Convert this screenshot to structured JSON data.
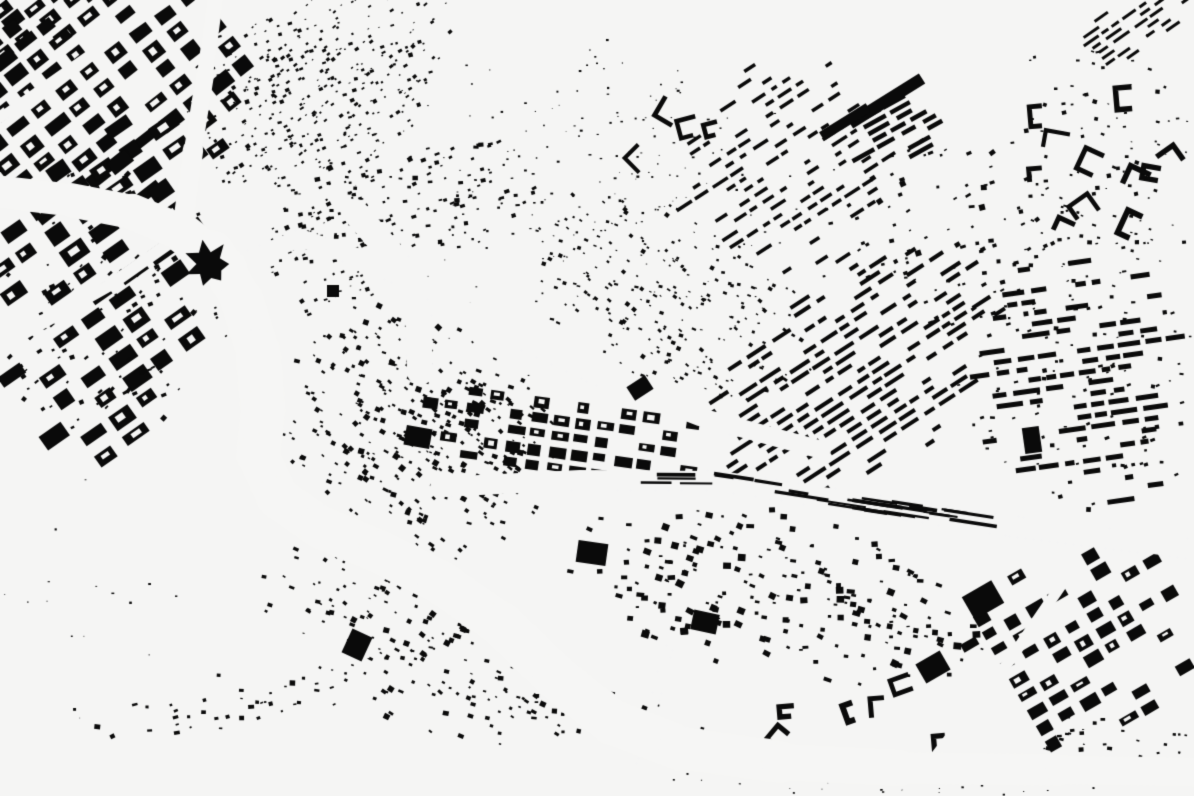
{
  "map": {
    "kind": "figure-ground-building-footprint-map",
    "canvas": {
      "width": 1194,
      "height": 796
    },
    "seed": 1337,
    "colors": {
      "background": "#f5f5f4",
      "buildings": "#0a0a0a",
      "water": "#f6f6f5"
    },
    "districts": [
      {
        "name": "nw-corner-grid",
        "type": "grid",
        "cx": 95,
        "cy": 85,
        "w": 380,
        "h": 260,
        "rot": -38,
        "block": [
          24,
          15
        ],
        "gap": 7,
        "skip": 0.12,
        "hole": 0.5,
        "fade": 2.0
      },
      {
        "name": "nw-corner-cap",
        "type": "grid",
        "cx": 40,
        "cy": 30,
        "w": 170,
        "h": 130,
        "rot": -38,
        "block": [
          22,
          14
        ],
        "gap": 6,
        "skip": 0.1,
        "hole": 0.4,
        "fade": 1.2
      },
      {
        "name": "nw-hill-texture",
        "type": "scatter",
        "cx": 320,
        "cy": 80,
        "w": 300,
        "h": 200,
        "rot": -28,
        "count": 700,
        "size": [
          1.5,
          4.5
        ],
        "fade": 2.2
      },
      {
        "name": "west-bank-grid-north",
        "type": "grid",
        "cx": 100,
        "cy": 230,
        "w": 310,
        "h": 210,
        "rot": -35,
        "block": [
          28,
          17
        ],
        "gap": 8,
        "skip": 0.12,
        "hole": 0.55,
        "fade": 1.8
      },
      {
        "name": "west-bank-grid-south",
        "type": "grid",
        "cx": 115,
        "cy": 370,
        "w": 270,
        "h": 170,
        "rot": -35,
        "block": [
          26,
          16
        ],
        "gap": 8,
        "skip": 0.14,
        "hole": 0.5,
        "fade": 1.6
      },
      {
        "name": "west-bank-infill",
        "type": "scatter",
        "cx": 110,
        "cy": 300,
        "w": 310,
        "h": 290,
        "rot": -35,
        "count": 260,
        "size": [
          2,
          6
        ],
        "fade": 2.0
      },
      {
        "name": "junction-east-scatter",
        "type": "scatter",
        "cx": 330,
        "cy": 250,
        "w": 175,
        "h": 125,
        "rot": -18,
        "count": 150,
        "size": [
          1.5,
          4.5
        ],
        "fade": 1.7
      },
      {
        "name": "north-bank-strip",
        "type": "scatter",
        "cx": 395,
        "cy": 205,
        "w": 310,
        "h": 125,
        "rot": -12,
        "count": 330,
        "size": [
          2,
          5.5
        ],
        "fade": 1.8
      },
      {
        "name": "center-slope",
        "type": "scatter",
        "cx": 415,
        "cy": 430,
        "w": 310,
        "h": 245,
        "rot": 30,
        "count": 680,
        "size": [
          2,
          6
        ],
        "fade": 1.7
      },
      {
        "name": "central-grid",
        "type": "grid",
        "cx": 565,
        "cy": 437,
        "w": 335,
        "h": 105,
        "rot": 8,
        "block": [
          17,
          11
        ],
        "gap": 5,
        "skip": 0.12,
        "hole": 0.4,
        "fade": 1.3
      },
      {
        "name": "mid-hill-wedge",
        "type": "scatter",
        "cx": 670,
        "cy": 300,
        "w": 330,
        "h": 175,
        "rot": 27,
        "count": 520,
        "size": [
          1.5,
          4.5
        ],
        "fade": 1.7
      },
      {
        "name": "hillside-grain",
        "type": "dots",
        "cx": 560,
        "cy": 220,
        "w": 640,
        "h": 380,
        "rot": 0,
        "count": 240,
        "size": [
          1,
          2.5
        ],
        "fade": 0.8
      },
      {
        "name": "top-center-sparse",
        "type": "dots",
        "cx": 600,
        "cy": 160,
        "w": 250,
        "h": 250,
        "rot": 0,
        "count": 170,
        "size": [
          1,
          3
        ],
        "fade": 1.2
      },
      {
        "name": "top-center-hooks",
        "type": "hooks",
        "cx": 650,
        "cy": 135,
        "w": 155,
        "h": 120,
        "rot": -15,
        "count": 13,
        "arm": [
          10,
          22
        ],
        "stroke": [
          3.5,
          5.5
        ],
        "fade": 1.2
      },
      {
        "name": "ne-upper-stripes",
        "type": "rows",
        "cx": 790,
        "cy": 165,
        "w": 270,
        "h": 250,
        "rot": -33,
        "pitch": 10,
        "bar": 3.5,
        "seg": [
          6,
          18
        ],
        "skip": 0.38,
        "fade": 1.8
      },
      {
        "name": "ne-terrace-stripes",
        "type": "rows",
        "cx": 850,
        "cy": 375,
        "w": 400,
        "h": 235,
        "rot": -33,
        "pitch": 9,
        "bar": 4,
        "seg": [
          8,
          26
        ],
        "skip": 0.22,
        "fade": 1.5
      },
      {
        "name": "n-mid-scatter",
        "type": "scatter",
        "cx": 940,
        "cy": 240,
        "w": 265,
        "h": 225,
        "rot": -20,
        "count": 185,
        "size": [
          2,
          6
        ],
        "fade": 1.8
      },
      {
        "name": "industrial-rows",
        "type": "rows",
        "cx": 893,
        "cy": 126,
        "w": 105,
        "h": 78,
        "rot": -29,
        "pitch": 8,
        "bar": 4.5,
        "seg": [
          14,
          28
        ],
        "skip": 0.1,
        "fade": 1.0
      },
      {
        "name": "top-right-hooks",
        "type": "hooks",
        "cx": 1105,
        "cy": 150,
        "w": 205,
        "h": 275,
        "rot": 10,
        "count": 30,
        "arm": [
          12,
          26
        ],
        "stroke": [
          4,
          6
        ],
        "fade": 1.3
      },
      {
        "name": "top-right-scatter",
        "type": "scatter",
        "cx": 1100,
        "cy": 160,
        "w": 215,
        "h": 295,
        "rot": 5,
        "count": 210,
        "size": [
          1.5,
          4.5
        ],
        "fade": 1.6
      },
      {
        "name": "top-right-corner-rows",
        "type": "rows",
        "cx": 1140,
        "cy": 22,
        "w": 145,
        "h": 70,
        "rot": -35,
        "pitch": 7,
        "bar": 3,
        "seg": [
          8,
          20
        ],
        "skip": 0.2,
        "fade": 1.2
      },
      {
        "name": "east-rows",
        "type": "rows",
        "cx": 1080,
        "cy": 380,
        "w": 255,
        "h": 305,
        "rot": -8,
        "pitch": 11,
        "bar": 5,
        "seg": [
          8,
          28
        ],
        "skip": 0.3,
        "fade": 1.5
      },
      {
        "name": "east-scatter",
        "type": "scatter",
        "cx": 1080,
        "cy": 380,
        "w": 245,
        "h": 295,
        "rot": -8,
        "count": 230,
        "size": [
          2,
          5
        ],
        "fade": 1.7
      },
      {
        "name": "south-band",
        "type": "scatter",
        "cx": 780,
        "cy": 595,
        "w": 435,
        "h": 165,
        "rot": 12,
        "count": 450,
        "size": [
          2.5,
          8
        ],
        "fade": 1.5
      },
      {
        "name": "south-curved-rows",
        "type": "hooks",
        "cx": 855,
        "cy": 712,
        "w": 290,
        "h": 88,
        "rot": 10,
        "count": 13,
        "arm": [
          10,
          20
        ],
        "stroke": [
          4.5,
          6
        ],
        "fade": 1.1
      },
      {
        "name": "se-grid",
        "type": "grid",
        "cx": 1090,
        "cy": 655,
        "w": 265,
        "h": 255,
        "rot": -30,
        "block": [
          19,
          12
        ],
        "gap": 6,
        "skip": 0.22,
        "hole": 0.35,
        "fade": 1.5
      },
      {
        "name": "se-bottom-scatter",
        "type": "scatter",
        "cx": 1110,
        "cy": 750,
        "w": 185,
        "h": 75,
        "rot": 0,
        "count": 85,
        "size": [
          1.5,
          5
        ],
        "fade": 1.4
      },
      {
        "name": "sw-bend",
        "type": "scatter",
        "cx": 420,
        "cy": 645,
        "w": 345,
        "h": 175,
        "rot": 25,
        "count": 360,
        "size": [
          2,
          6
        ],
        "fade": 1.5
      },
      {
        "name": "bottom-left-strip",
        "type": "scatter",
        "cx": 225,
        "cy": 705,
        "w": 285,
        "h": 62,
        "rot": -10,
        "count": 85,
        "size": [
          2,
          6
        ],
        "fade": 1.3
      },
      {
        "name": "river-bank-chain",
        "type": "scatter",
        "cx": 600,
        "cy": 715,
        "w": 345,
        "h": 58,
        "rot": 13,
        "count": 115,
        "size": [
          2,
          6
        ],
        "fade": 1.2
      },
      {
        "name": "sw-open-specks",
        "type": "dots",
        "cx": 90,
        "cy": 600,
        "w": 260,
        "h": 280,
        "rot": 0,
        "count": 35,
        "size": [
          1,
          3
        ],
        "fade": 0.9
      },
      {
        "name": "south-of-river-specks",
        "type": "dots",
        "cx": 860,
        "cy": 780,
        "w": 500,
        "h": 42,
        "rot": 2,
        "count": 90,
        "size": [
          1,
          2.5
        ],
        "fade": 1.2
      }
    ],
    "waterways": [
      {
        "name": "north-channel",
        "points": [
          [
            215,
            0
          ],
          [
            205,
            75
          ],
          [
            193,
            150
          ],
          [
            183,
            225
          ]
        ],
        "width": [
          15,
          17,
          19,
          22
        ]
      },
      {
        "name": "west-arm",
        "points": [
          [
            0,
            192
          ],
          [
            70,
            200
          ],
          [
            132,
            212
          ],
          [
            182,
            233
          ],
          [
            228,
            268
          ]
        ],
        "width": [
          32,
          33,
          35,
          38,
          42
        ]
      },
      {
        "name": "main-river",
        "points": [
          [
            214,
            252
          ],
          [
            242,
            300
          ],
          [
            258,
            352
          ],
          [
            263,
            410
          ],
          [
            258,
            455
          ],
          [
            278,
            498
          ],
          [
            320,
            527
          ],
          [
            380,
            552
          ],
          [
            440,
            582
          ],
          [
            502,
            625
          ],
          [
            556,
            677
          ],
          [
            612,
            722
          ],
          [
            680,
            748
          ],
          [
            780,
            762
          ],
          [
            900,
            768
          ],
          [
            1060,
            770
          ],
          [
            1194,
            772
          ]
        ],
        "width": [
          42,
          44,
          46,
          46,
          44,
          44,
          44,
          44,
          44,
          46,
          48,
          46,
          46,
          40,
          34,
          30,
          28
        ]
      }
    ],
    "roads": [
      {
        "name": "nw-avenue",
        "points": [
          [
            0,
            118
          ],
          [
            168,
            0
          ]
        ],
        "width": 10
      },
      {
        "name": "west-bank-avenue",
        "points": [
          [
            0,
            347
          ],
          [
            110,
            285
          ],
          [
            185,
            232
          ]
        ],
        "width": 12
      },
      {
        "name": "valley-road",
        "points": [
          [
            228,
            268
          ],
          [
            300,
            238
          ],
          [
            360,
            258
          ],
          [
            432,
            292
          ],
          [
            520,
            340
          ],
          [
            610,
            382
          ],
          [
            700,
            417
          ],
          [
            822,
            450
          ]
        ],
        "width": 18
      },
      {
        "name": "slope-gap",
        "points": [
          [
            355,
            212
          ],
          [
            395,
            258
          ],
          [
            418,
            310
          ],
          [
            420,
            372
          ]
        ],
        "width": 26
      },
      {
        "name": "south-road",
        "points": [
          [
            620,
            796
          ],
          [
            655,
            700
          ],
          [
            668,
            650
          ]
        ],
        "width": 9
      },
      {
        "name": "se-road",
        "points": [
          [
            905,
            796
          ],
          [
            1010,
            660
          ],
          [
            1075,
            565
          ]
        ],
        "width": 11
      }
    ],
    "railway": {
      "name": "rail-corridor",
      "points": [
        [
          440,
          487
        ],
        [
          580,
          480
        ],
        [
          720,
          481
        ],
        [
          860,
          503
        ],
        [
          1010,
          526
        ],
        [
          1194,
          549
        ]
      ],
      "width": 20,
      "slivers": {
        "count": 26,
        "t": [
          0.26,
          0.76
        ],
        "len": [
          18,
          55
        ],
        "thick": [
          2,
          4
        ]
      }
    },
    "blobs": [
      {
        "name": "citadel-star-blob",
        "shape": "star",
        "x": 208,
        "y": 264,
        "r": 24
      },
      {
        "name": "industrial-long-bar",
        "shape": "rect",
        "x": 886,
        "y": 101,
        "w": 85,
        "h": 12,
        "rot": -32
      },
      {
        "name": "industrial-bar-2",
        "shape": "rect",
        "x": 845,
        "y": 122,
        "w": 55,
        "h": 10,
        "rot": -32
      },
      {
        "name": "west-large-building",
        "shape": "rect",
        "x": 418,
        "y": 437,
        "w": 26,
        "h": 20,
        "rot": 10
      },
      {
        "name": "east-large-building",
        "shape": "rect",
        "x": 1032,
        "y": 440,
        "w": 17,
        "h": 26,
        "rot": -8
      },
      {
        "name": "se-large-building-1",
        "shape": "rect",
        "x": 983,
        "y": 600,
        "w": 34,
        "h": 26,
        "rot": -30
      },
      {
        "name": "se-large-building-2",
        "shape": "rect",
        "x": 933,
        "y": 667,
        "w": 28,
        "h": 22,
        "rot": -30
      },
      {
        "name": "south-large-building-1",
        "shape": "rect",
        "x": 705,
        "y": 622,
        "w": 26,
        "h": 20,
        "rot": 12
      },
      {
        "name": "south-large-building-2",
        "shape": "rect",
        "x": 592,
        "y": 553,
        "w": 30,
        "h": 22,
        "rot": 8
      },
      {
        "name": "sw-large-building",
        "shape": "rect",
        "x": 357,
        "y": 645,
        "w": 22,
        "h": 26,
        "rot": 25
      },
      {
        "name": "ne-large-building",
        "shape": "rect",
        "x": 640,
        "y": 388,
        "w": 22,
        "h": 16,
        "rot": -33
      },
      {
        "name": "nw-large-building",
        "shape": "rect",
        "x": 120,
        "y": 162,
        "w": 24,
        "h": 15,
        "rot": -38
      },
      {
        "name": "mid-small-blob",
        "shape": "rect",
        "x": 333,
        "y": 291,
        "w": 12,
        "h": 12,
        "rot": 0
      }
    ]
  }
}
